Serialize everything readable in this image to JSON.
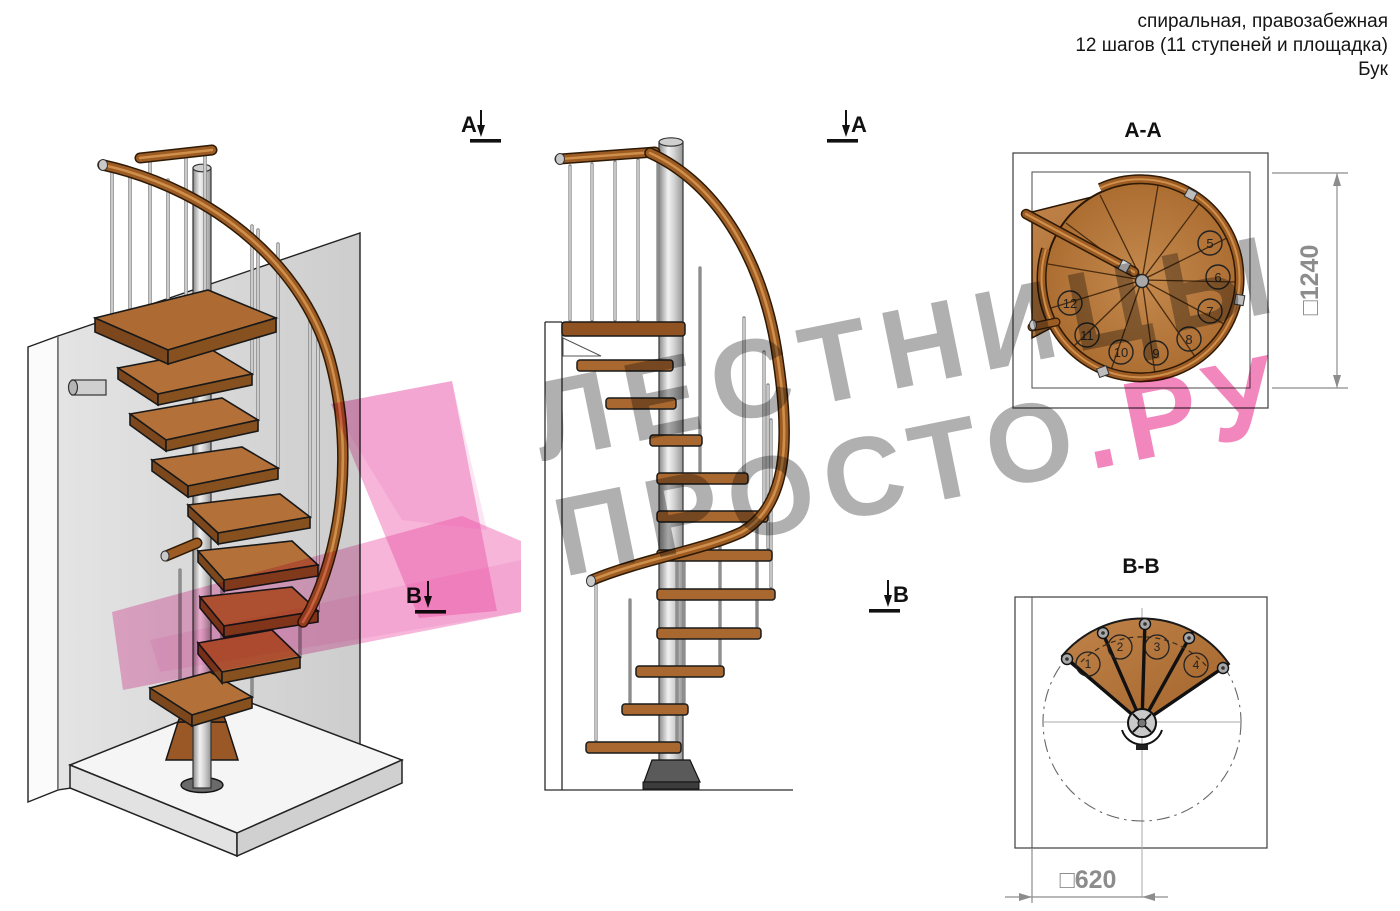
{
  "header": {
    "line1": "спиральная, правозабежная",
    "line2": "12 шагов (11 ступеней и площадка)",
    "line3": "Бук"
  },
  "section_markers": {
    "a_left": "А",
    "a_right": "А",
    "b_left": "В",
    "b_right": "В"
  },
  "section_aa": {
    "title": "А-А",
    "step_numbers": [
      "5",
      "6",
      "7",
      "8",
      "9",
      "10",
      "11",
      "12"
    ],
    "dimension_label": "□1240"
  },
  "section_bb": {
    "title": "В-В",
    "step_numbers": [
      "1",
      "2",
      "3",
      "4"
    ],
    "dimension_label": "□620"
  },
  "watermark": {
    "line1": "ЛЕСТНИЦЫ",
    "line2_gray": "ПРОСТО",
    "line2_pink": ".РУ"
  },
  "colors": {
    "wood": "#b07038",
    "wood_dark": "#7c471c",
    "handrail": "#9c5c24",
    "metal": "#d8d8d8",
    "wall": "#dedede",
    "dim_gray": "#8c8c8c",
    "watermark_gray": "#9b9b9b",
    "watermark_pink": "#f286bb",
    "ribbon_pink": "#f5b7db"
  }
}
